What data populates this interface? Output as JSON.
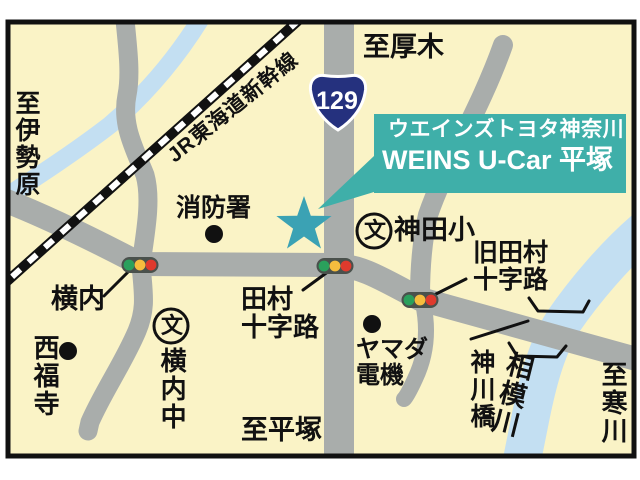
{
  "map": {
    "title_callout": {
      "line1": "ウエインズトヨタ神奈川",
      "line2": "WEINS U-Car 平塚"
    },
    "route_shield": {
      "number": "129"
    },
    "railway_label": "JR東海道新幹線",
    "directions": {
      "top": "至厚木",
      "left": "至伊勢原",
      "bottom": "至平塚",
      "right": "至寒川"
    },
    "intersections": {
      "yokouchi": "横内",
      "tamura_line1": "田村",
      "tamura_line2": "十字路",
      "kyu_tamura_line1": "旧田村",
      "kyu_tamura_line2": "十字路"
    },
    "landmarks": {
      "fire_station": "消防署",
      "kanda_elementary": "神田小",
      "school_symbol": "文",
      "saifukuji_temple": "西福寺",
      "yokouchi_junior_high": "横内中",
      "yamada_line1": "ヤマダ",
      "yamada_line2": "電機"
    },
    "water": {
      "sagami_river": "相模川",
      "kamikawa_bridge": "神川橋"
    },
    "colors": {
      "background": "#FAF3C6",
      "road": "#A9ADAB",
      "river": "#C3DFF2",
      "callout": "#3FAFA9",
      "star": "#3BA2B4",
      "shield": "#25317E",
      "signal_housing": "#4A514C",
      "signal_green": "#2AA05C",
      "signal_yellow": "#F6BC3E",
      "signal_red": "#DF3A2D"
    }
  }
}
